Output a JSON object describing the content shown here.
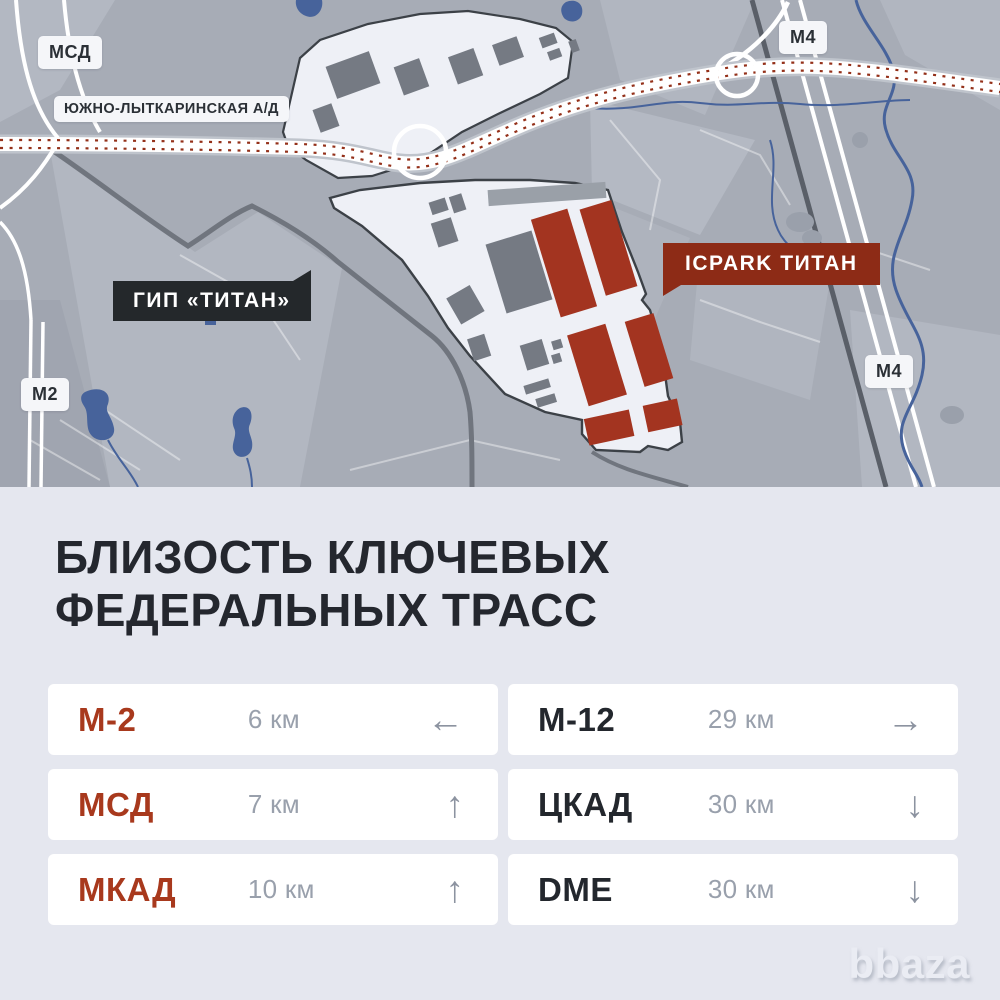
{
  "map": {
    "road_labels": {
      "msd": "МСД",
      "ulk": "ЮЖНО-ЛЫТКАРИНСКАЯ А/Д",
      "m2": "М2",
      "m4_top": "М4",
      "m4_bottom": "М4"
    },
    "site_labels": {
      "gip": "ГИП «ТИТАН»",
      "icpark": "ICPARK ТИТАН"
    }
  },
  "info": {
    "title": "БЛИЗОСТЬ КЛЮЧЕВЫХ\nФЕДЕРАЛЬНЫХ ТРАСС",
    "rows": [
      {
        "label": "М-2",
        "distance": "6 км",
        "arrow": "←",
        "accent": true
      },
      {
        "label": "М-12",
        "distance": "29 км",
        "arrow": "→",
        "accent": false
      },
      {
        "label": "МСД",
        "distance": "7 км",
        "arrow": "↑",
        "accent": true
      },
      {
        "label": "ЦКАД",
        "distance": "30 км",
        "arrow": "↓",
        "accent": false
      },
      {
        "label": "МКАД",
        "distance": "10 км",
        "arrow": "↑",
        "accent": true
      },
      {
        "label": "DME",
        "distance": "30 км",
        "arrow": "↓",
        "accent": false
      }
    ]
  },
  "watermark": {
    "text": "bbaza"
  },
  "colors": {
    "accent_red": "#A8391D",
    "brick_building": "#A33420",
    "flag_red": "#8D2B16",
    "flag_dark": "#24282B",
    "panel_bg": "#E5E7EF",
    "card_bg": "#FFFFFF",
    "map_bg": "#A7ACB6",
    "water": "#47639B",
    "text_dark": "#23272D",
    "text_gray": "#99A0AC"
  }
}
